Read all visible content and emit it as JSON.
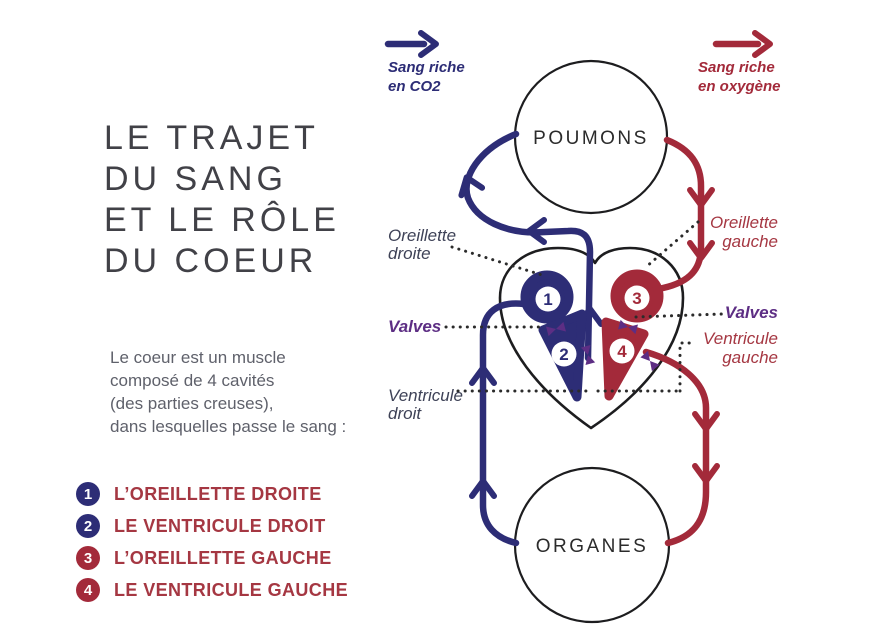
{
  "title": {
    "lines": [
      "LE TRAJET",
      "DU SANG",
      "ET LE RÔLE",
      "DU COEUR"
    ]
  },
  "intro": {
    "lines": [
      "Le coeur est un muscle",
      "composé de 4 cavités",
      "(des parties creuses),",
      "dans lesquelles passe le sang :"
    ]
  },
  "cavities": {
    "items": [
      {
        "num": "1",
        "label": "L’OREILLETTE DROITE"
      },
      {
        "num": "2",
        "label": "LE VENTRICULE DROIT"
      },
      {
        "num": "3",
        "label": "L’OREILLETTE GAUCHE"
      },
      {
        "num": "4",
        "label": "LE VENTRICULE GAUCHE"
      }
    ]
  },
  "legend": {
    "co2": {
      "line1": "Sang riche",
      "line2": "en CO2"
    },
    "oxygen": {
      "line1": "Sang riche",
      "line2": "en oxygène"
    }
  },
  "diagram": {
    "nodes": {
      "lungs": "POUMONS",
      "organs": "ORGANES"
    },
    "labels": {
      "right_atrium": {
        "line1": "Oreillette",
        "line2": "droite"
      },
      "left_atrium": {
        "line1": "Oreillette",
        "line2": "gauche"
      },
      "valves_left": "Valves",
      "valves_right": "Valves",
      "right_ventricle": {
        "line1": "Ventricule",
        "line2": "droit"
      },
      "left_ventricle": {
        "line1": "Ventricule",
        "line2": "gauche"
      }
    }
  },
  "colors": {
    "navy": "#2d2d76",
    "crimson": "#a32a3a",
    "purple": "#5d2e84",
    "slate_label": "#3e4257",
    "list_text_red": "#a53742",
    "title_gray": "#414147",
    "body_gray": "#5f616b",
    "outline_ink": "#1d1d1f"
  }
}
